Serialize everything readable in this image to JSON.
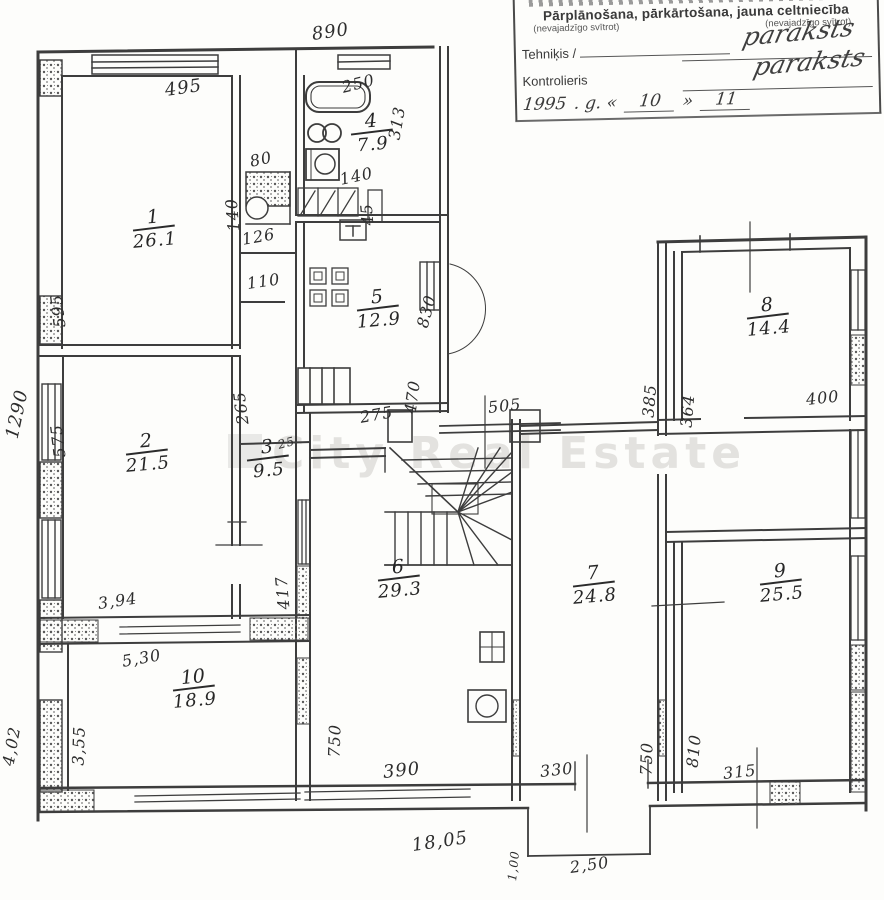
{
  "header": {
    "line1": "Pārplānošana, pārkārtošana, jauna celtniecība",
    "note_left": "(nevajadzīgo svītrot)",
    "note_right": "(nevajadzīgo svītrot)",
    "technician_label": "Tehniķis /",
    "controller_label": "Kontrolieris",
    "signature_technician": "paraksts",
    "signature_controller": "paraksts",
    "date": {
      "year": "1995",
      "g": ". g. «",
      "month": "10",
      "quote_close": "»",
      "day": "11"
    }
  },
  "watermark": "City Real Estate",
  "rooms": [
    {
      "num": "1",
      "area": "26.1"
    },
    {
      "num": "2",
      "area": "21.5"
    },
    {
      "num": "3",
      "area": "9.5"
    },
    {
      "num": "4",
      "area": "7.9"
    },
    {
      "num": "5",
      "area": "12.9"
    },
    {
      "num": "6",
      "area": "29.3"
    },
    {
      "num": "7",
      "area": "24.8"
    },
    {
      "num": "8",
      "area": "14.4"
    },
    {
      "num": "9",
      "area": "25.5"
    },
    {
      "num": "10",
      "area": "18.9"
    }
  ],
  "dims": {
    "top_overall": "890",
    "room1_top": "495",
    "room1_left": "595",
    "room2_left": "575",
    "left_overall": "1290",
    "stove_width": "80",
    "stove_height": "140",
    "hall_126": "126",
    "hall_110": "110",
    "hall_265": "265",
    "bath_top": "250",
    "bath_right": "313",
    "bath_140": "140",
    "bath_45": "45",
    "kitchen_830": "830",
    "kitchen_470": "470",
    "kitchen_275": "275",
    "wall_25": "25",
    "room2_bottom": "3,94",
    "room3_417": "417",
    "corridor_505": "505",
    "corridor_385": "385",
    "room8_left": "364",
    "room8_bottom": "400",
    "room10_top": "5,30",
    "room10_left": "3,55",
    "left_lower": "4,02",
    "room6_left": "750",
    "room6_bottom": "390",
    "bottom_overall": "18,05",
    "room7_bottom": "330",
    "room7_right": "750",
    "room9_left": "810",
    "room9_bottom": "315",
    "porch_side": "1,00",
    "porch_width": "2,50"
  }
}
